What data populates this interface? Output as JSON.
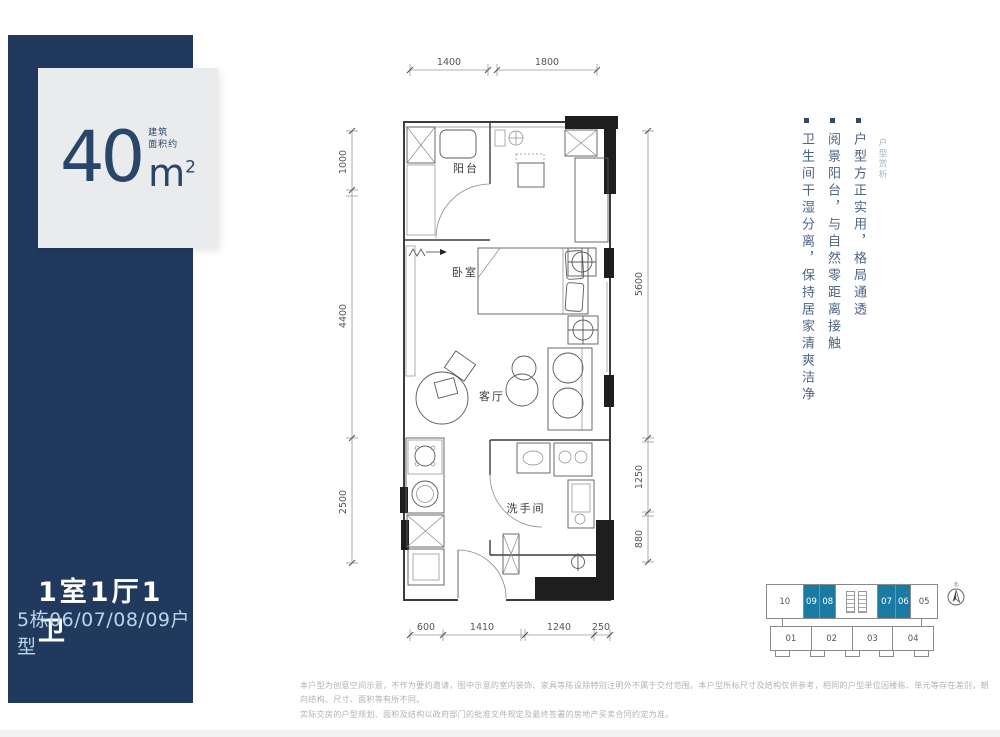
{
  "left_panel": {
    "area_value": "40",
    "area_unit": "m",
    "area_sup": "2",
    "area_note_line1": "建筑",
    "area_note_line2": "面积约",
    "layout_title": "1室1厅1卫",
    "unit_subtitle": "5栋06/07/08/09户型"
  },
  "floor_plan": {
    "rooms": {
      "balcony": "阳台",
      "bedroom": "卧室",
      "living": "客厅",
      "bathroom": "洗手间"
    },
    "dimensions": {
      "top": [
        "1400",
        "1800"
      ],
      "left": [
        "1000",
        "4400",
        "2500"
      ],
      "right": [
        "5600",
        "1250",
        "880"
      ],
      "bottom": [
        "600",
        "1410",
        "1240",
        "250"
      ]
    }
  },
  "analysis": {
    "label": "户型赏析",
    "bullets": [
      "户型方正实用，格局通透",
      "阅景阳台，与自然零距离接触",
      "卫生间干湿分离，保持居家清爽洁净"
    ]
  },
  "key_plan": {
    "top_units": [
      {
        "no": "10",
        "highlighted": false
      },
      {
        "no": "09",
        "highlighted": true
      },
      {
        "no": "08",
        "highlighted": true
      },
      {
        "no": "07",
        "highlighted": true
      },
      {
        "no": "06",
        "highlighted": true
      },
      {
        "no": "05",
        "highlighted": false
      }
    ],
    "bottom_units": [
      {
        "no": "01"
      },
      {
        "no": "02"
      },
      {
        "no": "03"
      },
      {
        "no": "04"
      }
    ],
    "compass_label": "北"
  },
  "disclaimer": {
    "line1": "本户型为创意空间示意，不作为要约邀请，图中示意的室内装饰、家具等陈设除特别注明外不属于交付范围。本户型所标尺寸及结构仅供参考，相同的户型单位因楼栋、单元等存在差别，朝向结构、尺寸、面积等有所不同。",
    "line2": "实际交房的户型规划、面积及结构以政府部门的批准文件规定及最终签署的房地产买卖合同约定为准。"
  },
  "colors": {
    "navy": "#20395c",
    "light_box": "#e9ebec",
    "teal_highlight": "#1a7aa3",
    "analysis_text": "#4d6583",
    "subtitle_blue": "#b9d6ea"
  }
}
